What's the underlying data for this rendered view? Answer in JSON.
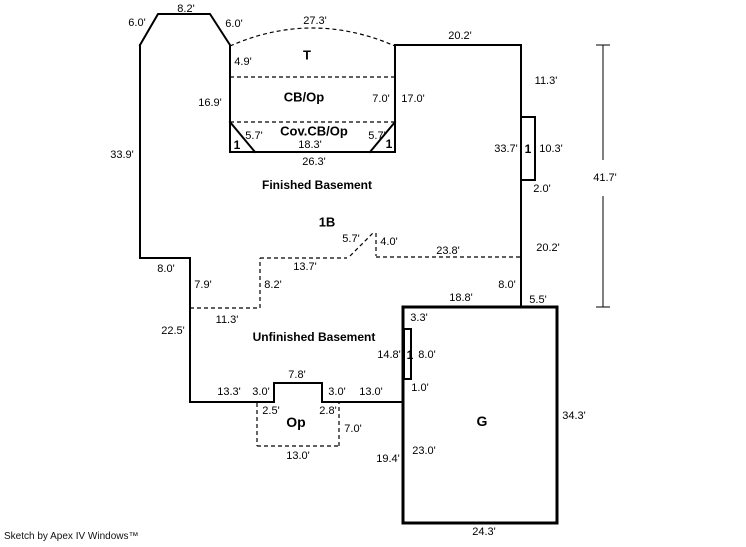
{
  "footer": {
    "credit": "Sketch by Apex IV Windows™"
  },
  "canvas": {
    "width": 746,
    "height": 547,
    "background": "#ffffff",
    "ink": "#000000"
  },
  "outlines": {
    "basement_perimeter": {
      "name": "basement-outline",
      "stroke_width": 2,
      "points": [
        [
          140,
          45
        ],
        [
          158,
          14
        ],
        [
          210,
          14
        ],
        [
          230,
          45
        ],
        [
          230,
          152
        ],
        [
          395,
          152
        ],
        [
          395,
          45
        ],
        [
          521,
          45
        ],
        [
          521,
          307
        ],
        [
          403,
          307
        ],
        [
          403,
          402
        ],
        [
          322,
          402
        ],
        [
          322,
          383
        ],
        [
          274,
          383
        ],
        [
          274,
          402
        ],
        [
          190,
          402
        ],
        [
          190,
          258
        ],
        [
          140,
          258
        ],
        [
          140,
          45
        ]
      ]
    },
    "garage": {
      "name": "garage-outline",
      "stroke_width": 3,
      "points": [
        [
          403,
          307
        ],
        [
          557,
          307
        ],
        [
          557,
          523
        ],
        [
          403,
          523
        ],
        [
          403,
          307
        ]
      ]
    },
    "corner_cuts": [
      {
        "name": "corner-cut-left",
        "points": [
          [
            230,
            122
          ],
          [
            255,
            152
          ]
        ]
      },
      {
        "name": "corner-cut-right",
        "points": [
          [
            395,
            122
          ],
          [
            370,
            152
          ]
        ]
      }
    ],
    "ports": [
      {
        "name": "port-right-wall",
        "x": 521,
        "y": 117,
        "w": 14,
        "h": 63
      },
      {
        "name": "port-garage-wall",
        "x": 404,
        "y": 329,
        "w": 7,
        "h": 50
      }
    ]
  },
  "dashed": {
    "lines": [
      {
        "name": "divider-t-cbop",
        "pts": [
          230,
          77,
          395,
          77
        ]
      },
      {
        "name": "divider-cbop-covcbop",
        "pts": [
          230,
          122,
          395,
          122
        ]
      },
      {
        "name": "unfin-boundary-11-3",
        "pts": [
          190,
          308,
          260,
          308
        ]
      },
      {
        "name": "unfin-boundary-8-2",
        "pts": [
          260,
          308,
          260,
          258
        ]
      },
      {
        "name": "fin-boundary-13-7",
        "pts": [
          260,
          258,
          347,
          258
        ]
      },
      {
        "name": "break-diagonal-5-7",
        "pts": [
          350,
          256,
          373,
          233
        ]
      },
      {
        "name": "break-vertical-4-0",
        "pts": [
          376,
          233,
          376,
          256
        ]
      },
      {
        "name": "fin-boundary-23-8",
        "pts": [
          376,
          257,
          521,
          257
        ]
      },
      {
        "name": "op-left-edge",
        "pts": [
          257,
          403,
          257,
          446
        ]
      },
      {
        "name": "op-bottom-edge",
        "pts": [
          257,
          446,
          339,
          446
        ]
      },
      {
        "name": "op-right-edge",
        "pts": [
          339,
          446,
          339,
          403
        ]
      }
    ],
    "curve": {
      "name": "deck-curve",
      "d": "M230,46 Q312,10 395,46"
    }
  },
  "dimension_line": {
    "name": "overall-dimension-41-7",
    "x": 603,
    "y1": 45,
    "y2": 307,
    "gap_top": 160,
    "gap_bottom": 196,
    "cap_half": 7,
    "label": "41.7'",
    "label_x": 605,
    "label_y": 178
  },
  "labels": [
    {
      "name": "dim-top-8-2",
      "text": "8.2'",
      "x": 186,
      "y": 9
    },
    {
      "name": "dim-slant-left-6-0",
      "text": "6.0'",
      "x": 137,
      "y": 23
    },
    {
      "name": "dim-slant-right-6-0",
      "text": "6.0'",
      "x": 234,
      "y": 24
    },
    {
      "name": "dim-deck-27-3",
      "text": "27.3'",
      "x": 315,
      "y": 21
    },
    {
      "name": "area-label-deck",
      "text": "T",
      "x": 307,
      "y": 55,
      "bold": true,
      "size": 13
    },
    {
      "name": "dim-4-9",
      "text": "4.9'",
      "x": 243,
      "y": 62
    },
    {
      "name": "area-label-cb-op",
      "text": "CB/Op",
      "x": 304,
      "y": 97,
      "bold": true,
      "size": 13
    },
    {
      "name": "dim-7-0",
      "text": "7.0'",
      "x": 381,
      "y": 99
    },
    {
      "name": "dim-17-0",
      "text": "17.0'",
      "x": 413,
      "y": 99
    },
    {
      "name": "dim-16-9",
      "text": "16.9'",
      "x": 210,
      "y": 103
    },
    {
      "name": "area-label-cov-cb-op",
      "text": "Cov.CB/Op",
      "x": 314,
      "y": 131,
      "bold": true,
      "size": 13
    },
    {
      "name": "dim-5-7-left",
      "text": "5.7'",
      "x": 254,
      "y": 136
    },
    {
      "name": "mark-1-left",
      "text": "1",
      "x": 237,
      "y": 145,
      "bold": true,
      "size": 12
    },
    {
      "name": "dim-5-7-right",
      "text": "5.7'",
      "x": 377,
      "y": 136
    },
    {
      "name": "mark-1-right",
      "text": "1",
      "x": 389,
      "y": 144,
      "bold": true,
      "size": 12
    },
    {
      "name": "dim-18-3",
      "text": "18.3'",
      "x": 310,
      "y": 145
    },
    {
      "name": "dim-26-3",
      "text": "26.3'",
      "x": 314,
      "y": 162
    },
    {
      "name": "dim-33-9",
      "text": "33.9'",
      "x": 122,
      "y": 155
    },
    {
      "name": "dim-20-2-top",
      "text": "20.2'",
      "x": 460,
      "y": 36
    },
    {
      "name": "dim-11-3-right",
      "text": "11.3'",
      "x": 546,
      "y": 81
    },
    {
      "name": "dim-33-7",
      "text": "33.7'",
      "x": 506,
      "y": 149
    },
    {
      "name": "mark-1-port-right",
      "text": "1",
      "x": 528,
      "y": 149,
      "bold": true,
      "size": 12
    },
    {
      "name": "dim-10-3",
      "text": "10.3'",
      "x": 551,
      "y": 149
    },
    {
      "name": "dim-2-0",
      "text": "2.0'",
      "x": 542,
      "y": 189
    },
    {
      "name": "dim-20-2-lower",
      "text": "20.2'",
      "x": 548,
      "y": 248
    },
    {
      "name": "area-label-finished-basement",
      "text": "Finished Basement",
      "x": 317,
      "y": 185,
      "bold": true,
      "size": 12
    },
    {
      "name": "area-label-1b",
      "text": "1B",
      "x": 327,
      "y": 222,
      "bold": true,
      "size": 13
    },
    {
      "name": "dim-5-7-break",
      "text": "5.7'",
      "x": 351,
      "y": 239
    },
    {
      "name": "dim-4-0",
      "text": "4.0'",
      "x": 389,
      "y": 242
    },
    {
      "name": "dim-23-8",
      "text": "23.8'",
      "x": 448,
      "y": 251
    },
    {
      "name": "dim-13-7",
      "text": "13.7'",
      "x": 305,
      "y": 267
    },
    {
      "name": "dim-8-2-dashed",
      "text": "8.2'",
      "x": 273,
      "y": 285
    },
    {
      "name": "dim-8-0-left",
      "text": "8.0'",
      "x": 166,
      "y": 269
    },
    {
      "name": "dim-7-9",
      "text": "7.9'",
      "x": 203,
      "y": 285
    },
    {
      "name": "dim-11-3-dashed",
      "text": "11.3'",
      "x": 227,
      "y": 320
    },
    {
      "name": "dim-22-5",
      "text": "22.5'",
      "x": 173,
      "y": 331
    },
    {
      "name": "area-label-unfinished-basement",
      "text": "Unfinished Basement",
      "x": 314,
      "y": 337,
      "bold": true,
      "size": 12
    },
    {
      "name": "dim-8-0-right",
      "text": "8.0'",
      "x": 507,
      "y": 285
    },
    {
      "name": "dim-18-8",
      "text": "18.8'",
      "x": 461,
      "y": 298
    },
    {
      "name": "dim-5-5",
      "text": "5.5'",
      "x": 538,
      "y": 300
    },
    {
      "name": "dim-3-3",
      "text": "3.3'",
      "x": 419,
      "y": 318
    },
    {
      "name": "dim-14-8",
      "text": "14.8'",
      "x": 389,
      "y": 355
    },
    {
      "name": "mark-1-port-garage",
      "text": "1",
      "x": 410,
      "y": 355,
      "bold": true,
      "size": 12
    },
    {
      "name": "dim-8-0-garage",
      "text": "8.0'",
      "x": 427,
      "y": 355
    },
    {
      "name": "dim-1-0",
      "text": "1.0'",
      "x": 420,
      "y": 388
    },
    {
      "name": "dim-13-3",
      "text": "13.3'",
      "x": 229,
      "y": 392
    },
    {
      "name": "dim-3-0-left",
      "text": "3.0'",
      "x": 261,
      "y": 392
    },
    {
      "name": "dim-7-8",
      "text": "7.8'",
      "x": 297,
      "y": 375
    },
    {
      "name": "dim-3-0-right",
      "text": "3.0'",
      "x": 337,
      "y": 392
    },
    {
      "name": "dim-13-0-top",
      "text": "13.0'",
      "x": 371,
      "y": 392
    },
    {
      "name": "dim-2-5",
      "text": "2.5'",
      "x": 271,
      "y": 411
    },
    {
      "name": "dim-2-8",
      "text": "2.8'",
      "x": 328,
      "y": 411
    },
    {
      "name": "area-label-op",
      "text": "Op",
      "x": 296,
      "y": 422,
      "bold": true,
      "size": 14
    },
    {
      "name": "dim-7-0-op",
      "text": "7.0'",
      "x": 353,
      "y": 429
    },
    {
      "name": "dim-13-0-bottom",
      "text": "13.0'",
      "x": 298,
      "y": 456
    },
    {
      "name": "dim-19-4",
      "text": "19.4'",
      "x": 388,
      "y": 459
    },
    {
      "name": "area-label-garage",
      "text": "G",
      "x": 482,
      "y": 421,
      "bold": true,
      "size": 14
    },
    {
      "name": "dim-23-0",
      "text": "23.0'",
      "x": 424,
      "y": 451
    },
    {
      "name": "dim-34-3",
      "text": "34.3'",
      "x": 574,
      "y": 416
    },
    {
      "name": "dim-24-3",
      "text": "24.3'",
      "x": 484,
      "y": 532
    }
  ]
}
